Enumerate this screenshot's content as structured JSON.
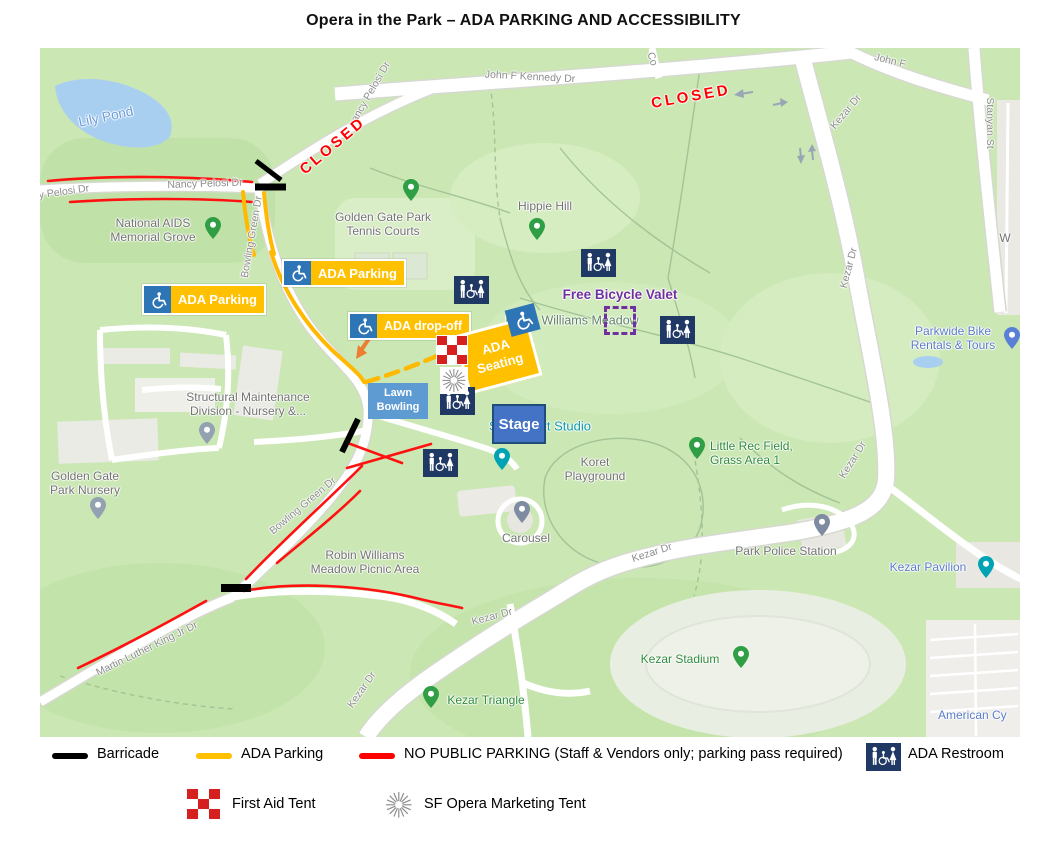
{
  "title": "Opera in the Park – ADA PARKING AND ACCESSIBILITY",
  "colors": {
    "ada_orange": "#FFC000",
    "no_parking_red": "#FF0000",
    "barricade_black": "#000000",
    "restroom_navy": "#1F3864",
    "valet_purple": "#7030A0",
    "stage_blue": "#4472C4",
    "lawn_bowling_blue": "#5E9BD3",
    "wheelchair_icon_blue": "#2E75B6",
    "dropoff_arrow_orange": "#ED7D31"
  },
  "map": {
    "road_labels": [
      {
        "text": "John F Kennedy Dr"
      },
      {
        "text": "John F"
      },
      {
        "text": "Co"
      },
      {
        "text": "Stanyan St"
      },
      {
        "text": "Kezar Dr"
      },
      {
        "text": "Kezar Dr"
      },
      {
        "text": "Kezar Dr"
      },
      {
        "text": "Kezar Dr"
      },
      {
        "text": "Kezar Dr"
      },
      {
        "text": "Kezar Dr"
      },
      {
        "text": "Nancy Pelosi Dr"
      },
      {
        "text": "y Pelosi Dr"
      },
      {
        "text": "ancy Pelosi Dr"
      },
      {
        "text": "Bowling Green Dr"
      },
      {
        "text": "Bowling Green Dr"
      },
      {
        "text": "Martin Luther King Jr Dr"
      }
    ],
    "closed_labels": [
      {
        "text": "CLOSED"
      },
      {
        "text": "CLOSED"
      }
    ],
    "places": [
      {
        "lines": [
          "National AIDS",
          "Memorial Grove"
        ]
      },
      {
        "lines": [
          "Golden Gate Park",
          "Tennis Courts"
        ]
      },
      {
        "text": "Hippie Hill"
      },
      {
        "text": "Robin Williams Meadow"
      },
      {
        "lines": [
          "Parkwide Bike",
          "Rentals & Tours"
        ]
      },
      {
        "lines": [
          "Little Rec Field,",
          "Grass Area 1"
        ]
      },
      {
        "lines": [
          "Golden Gate",
          "Park Nursery"
        ]
      },
      {
        "lines": [
          "Structural Maintenance",
          "Division - Nursery &..."
        ]
      },
      {
        "text": "Sharon Art Studio"
      },
      {
        "lines": [
          "Koret",
          "Playground"
        ]
      },
      {
        "text": "Carousel"
      },
      {
        "lines": [
          "Robin Williams",
          "Meadow Picnic Area"
        ]
      },
      {
        "text": "Park Police Station"
      },
      {
        "text": "Kezar Pavilion"
      },
      {
        "text": "Kezar Stadium"
      },
      {
        "text": "Kezar Triangle"
      },
      {
        "text": "American Cy"
      },
      {
        "text": "Lily Pond"
      },
      {
        "text": "W"
      }
    ],
    "overlays": {
      "ada_parking_1": "ADA Parking",
      "ada_parking_2": "ADA Parking",
      "ada_dropoff": "ADA drop-off",
      "ada_seating": [
        "ADA",
        "Seating"
      ],
      "lawn_bowling": [
        "Lawn",
        "Bowling"
      ],
      "stage": "Stage",
      "free_bicycle_valet": "Free Bicycle Valet"
    }
  },
  "legend": {
    "barricade": "Barricade",
    "ada_parking": "ADA Parking",
    "no_public_parking": "NO PUBLIC PARKING (Staff & Vendors only; parking pass required)",
    "ada_restroom": "ADA Restroom",
    "first_aid_tent": "First Aid Tent",
    "marketing_tent": "SF Opera Marketing Tent"
  }
}
